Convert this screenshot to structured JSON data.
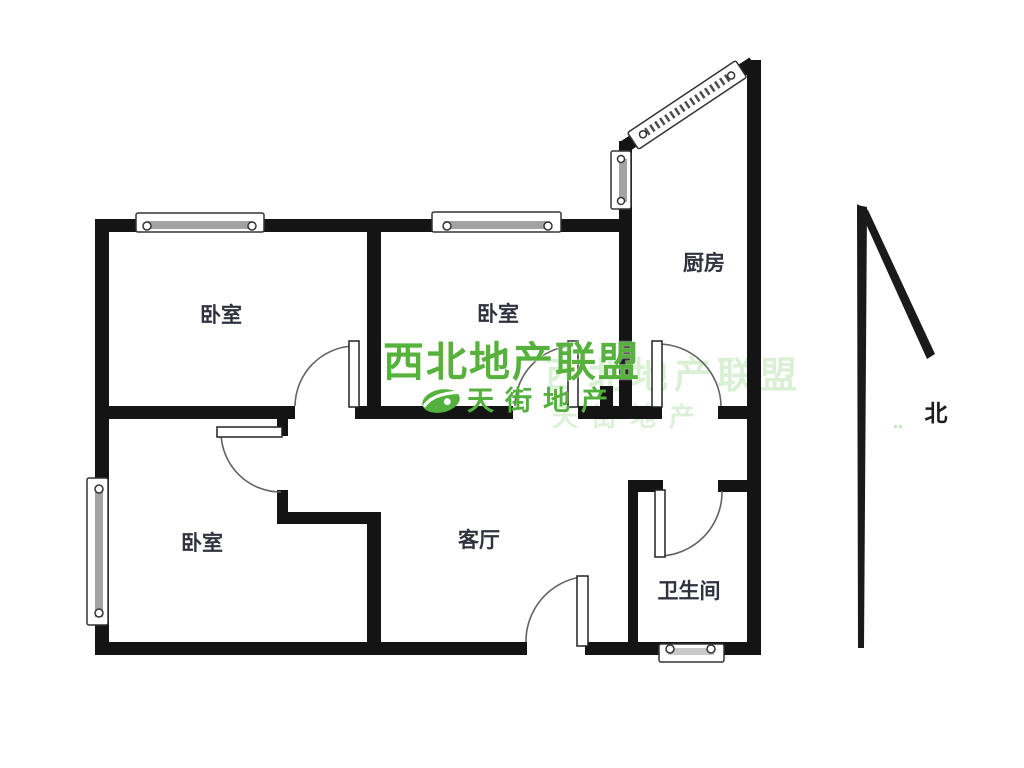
{
  "floor_plan": {
    "rooms": {
      "bedroom_top_left": "卧室",
      "bedroom_top_middle": "卧室",
      "bedroom_bottom_left": "卧室",
      "kitchen": "厨房",
      "living_room": "客厅",
      "bathroom": "卫生间"
    },
    "compass": {
      "north_label": "北",
      "dots": ".."
    },
    "watermark": {
      "title": "西北地产联盟",
      "subtitle": "天街地产",
      "ghost_title": "西北地产联盟",
      "ghost_subtitle": "天街地产",
      "title_color": "#56b23c",
      "subtitle_color": "#54b13e",
      "ghost_color": "#a8dd9d"
    },
    "colors": {
      "wall": "#141414",
      "door_arc": "#636363",
      "window_glass": "#a3a3a3",
      "label_text": "#30323f"
    }
  }
}
